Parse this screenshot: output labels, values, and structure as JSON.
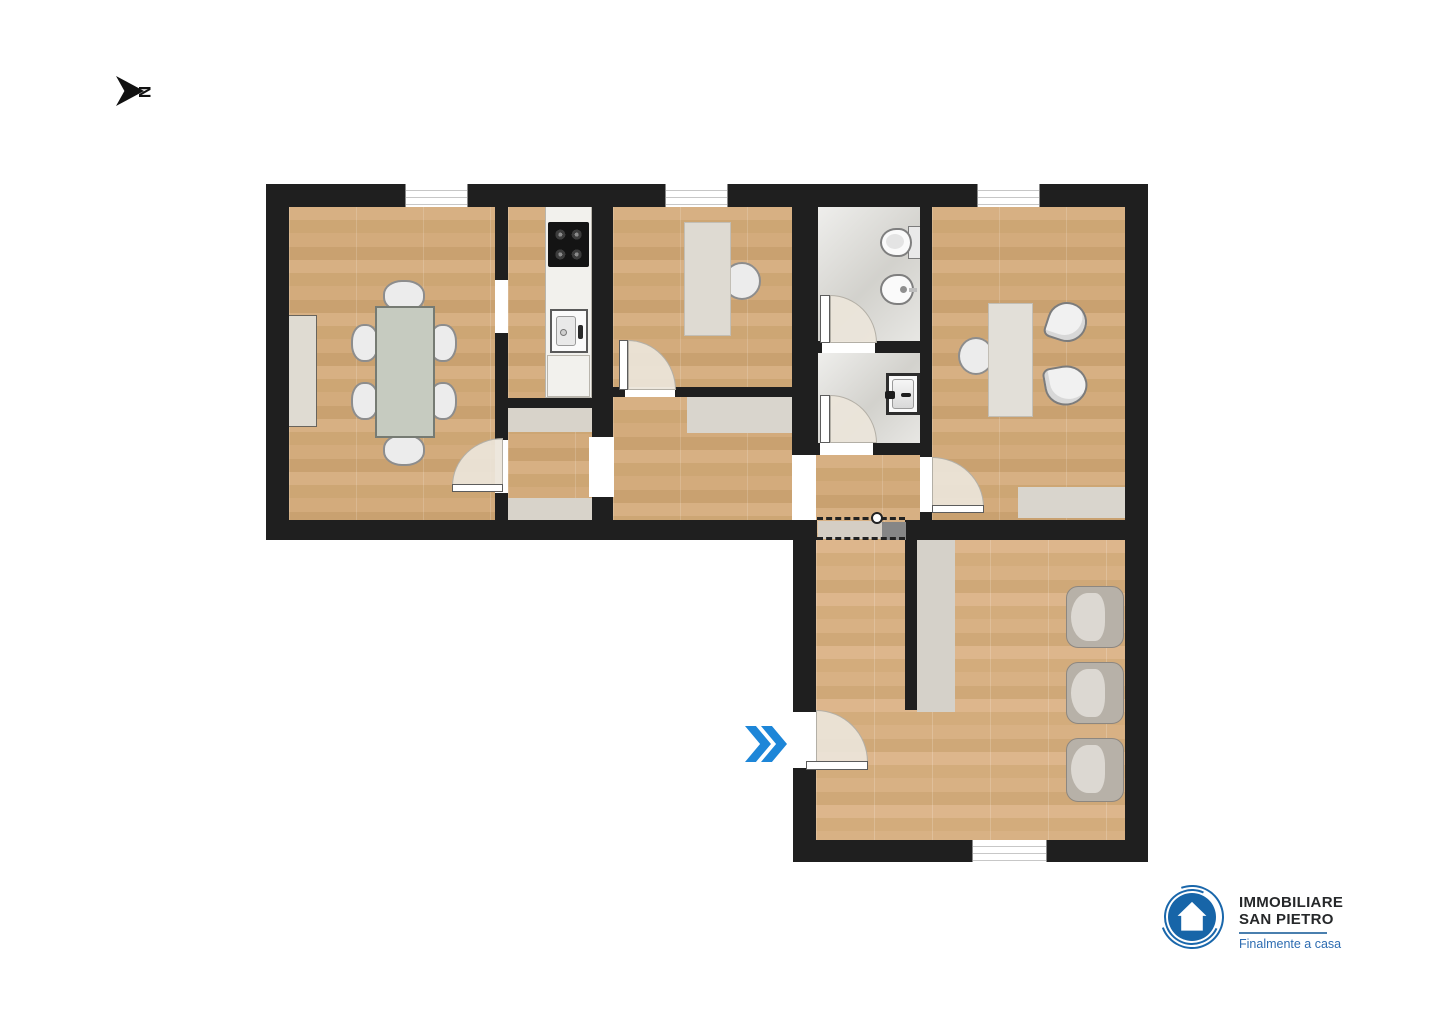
{
  "meta": {
    "type": "floor-plan",
    "orientation_arrow": "points-right"
  },
  "north_indicator": {
    "label": "N"
  },
  "entry_marker": {
    "shape": "double-chevron-right",
    "color": "#1d86d8"
  },
  "logo": {
    "line1": "IMMOBILIARE",
    "line2": "SAN PIETRO",
    "tagline": "Finalmente a casa",
    "brand_color": "#1765a8",
    "emblem": "blue-disc-with-white-house-and-brush-ring"
  },
  "palette": {
    "wall": "#1f1f1f",
    "wood_floor": "#d2a97a",
    "wood_floor_light": "#d9b186",
    "tile_floor": "#dbdad5",
    "furniture_light": "#dfdbd2",
    "table_sage": "#c6cbc0",
    "door_fill": "#ece5da",
    "armchair_gray": "#b7b1a8",
    "entry_arrow_blue": "#1d86d8"
  },
  "plan": {
    "shape": "L-shaped",
    "rooms": [
      {
        "id": "living-dining",
        "floor": "wood",
        "furniture": [
          "sideboard",
          "dining-table",
          "six-chairs"
        ],
        "windows": 1
      },
      {
        "id": "kitchen",
        "floor": "wood",
        "furniture": [
          "counter",
          "cooktop",
          "sink",
          "base-cabinet"
        ]
      },
      {
        "id": "vestibule",
        "floor": "wood",
        "furniture": [
          "doormat-top",
          "doormat-bottom"
        ]
      },
      {
        "id": "room-top-middle",
        "floor": "wood",
        "furniture": [
          "desk",
          "desk-chair"
        ],
        "windows": 1
      },
      {
        "id": "room-bottom-middle",
        "floor": "wood",
        "furniture": [
          "sideboard"
        ]
      },
      {
        "id": "bathroom",
        "floor": "tile",
        "furniture": [
          "toilet",
          "bidet"
        ]
      },
      {
        "id": "wc",
        "floor": "tile",
        "furniture": [
          "washbasin"
        ]
      },
      {
        "id": "hallway",
        "floor": "wood",
        "features": [
          "dashed-ceiling-hatch",
          "pull-ring",
          "gray-block"
        ]
      },
      {
        "id": "office-top-right",
        "floor": "wood",
        "furniture": [
          "table",
          "three-chairs",
          "sideboard"
        ],
        "windows": 1
      },
      {
        "id": "large-room-bottom-right",
        "floor": "wood",
        "furniture": [
          "partition-cabinet",
          "three-armchairs"
        ],
        "windows": 1,
        "entrance_door": true
      }
    ]
  }
}
